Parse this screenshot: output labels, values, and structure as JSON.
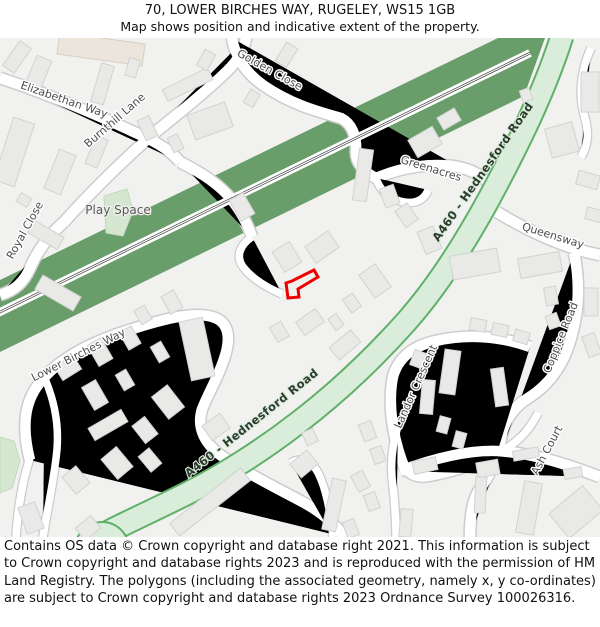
{
  "header": {
    "title": "70, LOWER BIRCHES WAY, RUGELEY, WS15 1GB",
    "subtitle": "Map shows position and indicative extent of the property."
  },
  "footer": {
    "text": "Contains OS data © Crown copyright and database right 2021. This information is subject to Crown copyright and database rights 2023 and is reproduced with the permission of HM Land Registry. The polygons (including the associated geometry, namely x, y co-ordinates) are subject to Crown copyright and database rights 2023 Ordnance Survey 100026316."
  },
  "map": {
    "labels": {
      "elizabethan_way": "Elizabethan Way",
      "golden_close": "Golden Close",
      "burnthill_lane": "Burnthill Lane",
      "royal_close": "Royal Close",
      "play_space": "Play Space",
      "greenacres": "Greenacres",
      "a460_top": "A460 - Hednesford Road",
      "queensway": "Queensway",
      "lower_birches_way": "Lower Birches Way",
      "a460_bottom": "A460 - Hednesford Road",
      "landor_crescent": "Landor Crescent",
      "coppice_road": "Coppice Road",
      "ash_court": "Ash Court"
    },
    "colors": {
      "railway_green": "#699e6b",
      "road_fill": "#d9edda",
      "road_border": "#5fb069",
      "green_space": "#d5e7d0",
      "building": "#e9e9e8",
      "building_border": "#d2d2d0",
      "street_fill": "#ffffff",
      "street_border": "#cccccc",
      "property_outline": "#ee0000",
      "background": "#f1f1ef"
    }
  }
}
